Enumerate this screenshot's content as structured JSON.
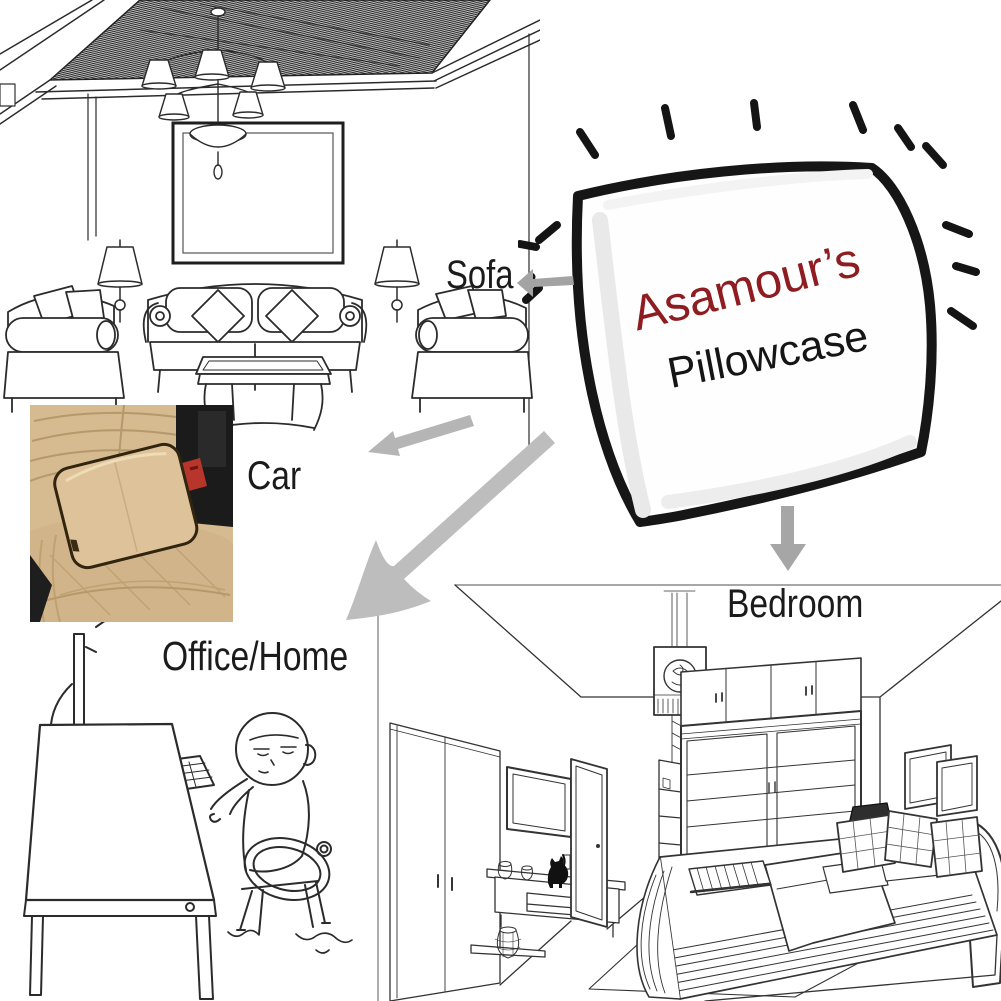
{
  "pillow_illustration": {
    "brand": "Asamour’s",
    "product": "Pillowcase",
    "icon": "hand-drawn-pillow-with-sparkle-dashes"
  },
  "usage_labels": {
    "sofa": "Sofa",
    "car": "Car",
    "office": "Office/Home",
    "bedroom": "Bedroom"
  },
  "scene_icons": {
    "sofa": "living-room-line-sketch",
    "car": "car-seat-pillow-photo",
    "office": "person-at-desk-cartoon",
    "bedroom": "bedroom-line-sketch"
  },
  "colors": {
    "brand-red": "#8e1c20",
    "label-black": "#1b1b1b",
    "arrow-gray": "#b0b0b0",
    "sketch-stroke": "#2b2b2b",
    "seat-beige": "#d6ba90",
    "pillow-beige": "#ddc29a",
    "console-black": "#1b1b1b",
    "buckle-red": "#b8352b"
  }
}
